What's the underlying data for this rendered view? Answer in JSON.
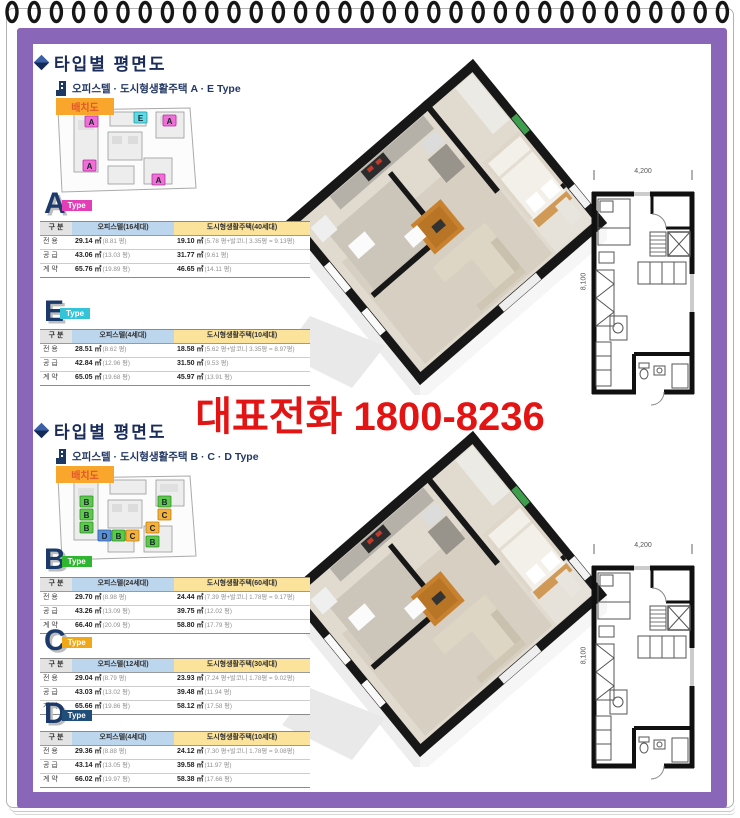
{
  "page": {
    "phone": "대표전화 1800-8236",
    "colors": {
      "frame_purple": "#8A66B8",
      "phone_red": "#E21414",
      "navy_text": "#1A2C59",
      "table_header_blue": "#BCD6EE",
      "table_header_yellow": "#FBE39B",
      "siteplan_badge_orange": "#F9A62C",
      "type_a_badge": "#E23EB8",
      "type_e_badge": "#35C4D7",
      "type_b_badge": "#2FB52F",
      "type_c_badge": "#F0A818",
      "type_d_badge": "#1F4E79"
    }
  },
  "sections": [
    {
      "title": "타입별  평면도",
      "subtitle": "오피스텔 · 도시형생활주택 A · E Type",
      "siteplan_label": "배치도",
      "siteplan_units": [
        "A",
        "E",
        "A",
        "A",
        "A"
      ],
      "plan": {
        "width_dim": "4,200",
        "height_dim": "8,100"
      },
      "types": [
        {
          "letter": "A",
          "badge": "Type",
          "badge_color": "#E23EB8",
          "columns": [
            "구 분",
            "오피스텔(16세대)",
            "도시형생활주택(40세대)"
          ],
          "rows": [
            {
              "label": "전 용",
              "o": "29.14 ㎡",
              "on": "(8.81 평)",
              "u": "19.10 ㎡",
              "un": "(5.78 평+발코니 3.35평 = 9.13평)"
            },
            {
              "label": "공 급",
              "o": "43.06 ㎡",
              "on": "(13.03 평)",
              "u": "31.77 ㎡",
              "un": "(9.61 평)"
            },
            {
              "label": "계 약",
              "o": "65.76 ㎡",
              "on": "(19.89 평)",
              "u": "46.65 ㎡",
              "un": "(14.11 평)"
            }
          ]
        },
        {
          "letter": "E",
          "badge": "Type",
          "badge_color": "#35C4D7",
          "columns": [
            "구 분",
            "오피스텔(4세대)",
            "도시형생활주택(10세대)"
          ],
          "rows": [
            {
              "label": "전 용",
              "o": "28.51 ㎡",
              "on": "(8.62 평)",
              "u": "18.58 ㎡",
              "un": "(5.62 평+발코니 3.35평 = 8.97평)"
            },
            {
              "label": "공 급",
              "o": "42.84 ㎡",
              "on": "(12.96 평)",
              "u": "31.50 ㎡",
              "un": "(9.53 평)"
            },
            {
              "label": "계 약",
              "o": "65.05 ㎡",
              "on": "(19.68 평)",
              "u": "45.97 ㎡",
              "un": "(13.91 평)"
            }
          ]
        }
      ]
    },
    {
      "title": "타입별  평면도",
      "subtitle": "오피스텔 · 도시형생활주택 B · C · D Type",
      "siteplan_label": "배치도",
      "siteplan_units": [
        "B",
        "B",
        "B",
        "B",
        "C",
        "D",
        "B",
        "C",
        "C",
        "B"
      ],
      "plan": {
        "width_dim": "4,200",
        "height_dim": "8,100"
      },
      "types": [
        {
          "letter": "B",
          "badge": "Type",
          "badge_color": "#2FB52F",
          "columns": [
            "구 분",
            "오피스텔(24세대)",
            "도시형생활주택(60세대)"
          ],
          "rows": [
            {
              "label": "전 용",
              "o": "29.70 ㎡",
              "on": "(8.98 평)",
              "u": "24.44 ㎡",
              "un": "(7.39 평+발코니 1.78평 = 9.17평)"
            },
            {
              "label": "공 급",
              "o": "43.26 ㎡",
              "on": "(13.09 평)",
              "u": "39.75 ㎡",
              "un": "(12.02 평)"
            },
            {
              "label": "계 약",
              "o": "66.40 ㎡",
              "on": "(20.09 평)",
              "u": "58.80 ㎡",
              "un": "(17.79 평)"
            }
          ]
        },
        {
          "letter": "C",
          "badge": "Type",
          "badge_color": "#F0A818",
          "columns": [
            "구 분",
            "오피스텔(12세대)",
            "도시형생활주택(30세대)"
          ],
          "rows": [
            {
              "label": "전 용",
              "o": "29.04 ㎡",
              "on": "(8.79 평)",
              "u": "23.93 ㎡",
              "un": "(7.24 평+발코니 1.78평 = 9.02평)"
            },
            {
              "label": "공 급",
              "o": "43.03 ㎡",
              "on": "(13.02 평)",
              "u": "39.48 ㎡",
              "un": "(11.94 평)"
            },
            {
              "label": "계 약",
              "o": "65.66 ㎡",
              "on": "(19.86 평)",
              "u": "58.12 ㎡",
              "un": "(17.58 평)"
            }
          ]
        },
        {
          "letter": "D",
          "badge": "Type",
          "badge_color": "#1F4E79",
          "columns": [
            "구 분",
            "오피스텔(4세대)",
            "도시형생활주택(10세대)"
          ],
          "rows": [
            {
              "label": "전 용",
              "o": "29.36 ㎡",
              "on": "(8.88 평)",
              "u": "24.12 ㎡",
              "un": "(7.30 평+발코니 1.78평 = 9.08평)"
            },
            {
              "label": "공 급",
              "o": "43.14 ㎡",
              "on": "(13.05 평)",
              "u": "39.58 ㎡",
              "un": "(11.97 평)"
            },
            {
              "label": "계 약",
              "o": "66.02 ㎡",
              "on": "(19.97 평)",
              "u": "58.38 ㎡",
              "un": "(17.66 평)"
            }
          ]
        }
      ]
    }
  ]
}
